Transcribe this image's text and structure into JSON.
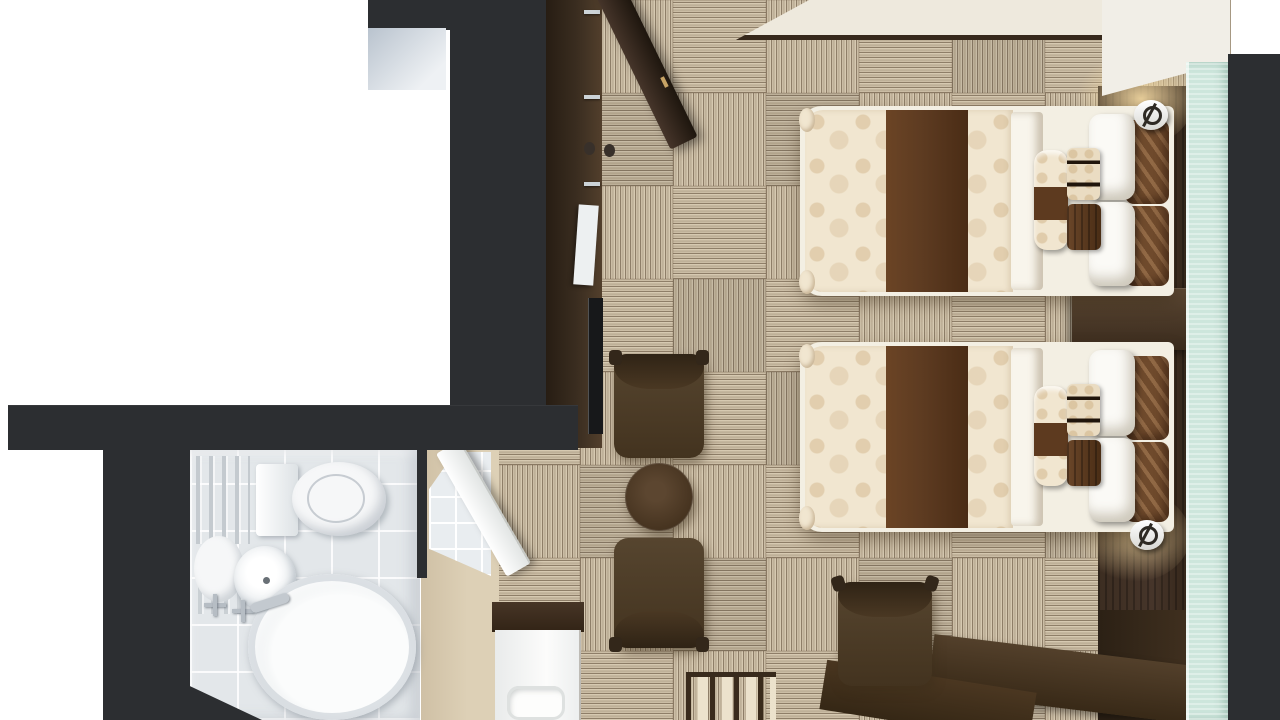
{
  "scene": {
    "type": "hotel-twin-room-floor-plan",
    "view": "top-down-3d-render",
    "rooms": [
      "bedroom",
      "bathroom",
      "entry-corridor"
    ]
  },
  "palette": {
    "wall_charcoal": "#2c2e31",
    "carpet_light": "#cbbda5",
    "carpet_dark": "#8e7e68",
    "entry_floor": "#ddd0b6",
    "wood_dark": "#3a2d20",
    "headboard_brown": "#46352a",
    "duvet_cream": "#f1e6d0",
    "runner_brown": "#5d3b21",
    "sheet_white": "#f8f5ec",
    "pillow_white": "#fbfaf6",
    "pillow_leaf": "#6f4a2c",
    "curtain_teal": "#cde6dc",
    "tile_gray": "#e3e7ea",
    "fixture_white": "#f6f7f8",
    "slab_cream": "#eee9dd",
    "panel_gray": "#b9c3ce",
    "tv_black": "#17181a",
    "glow_warm": "#f0d6a0"
  },
  "furniture": [
    {
      "name": "bed-1",
      "kind": "twin bed",
      "bedding": "cream floral duvet with brown runner"
    },
    {
      "name": "bed-2",
      "kind": "twin bed",
      "bedding": "cream floral duvet with brown runner"
    },
    {
      "name": "nightstand",
      "kind": "bedside table between beds"
    },
    {
      "name": "wall-sconce-1",
      "kind": "reading lamp above bed 1"
    },
    {
      "name": "wall-sconce-2",
      "kind": "reading lamp below bed 2"
    },
    {
      "name": "armchair-1",
      "kind": "lounge chair"
    },
    {
      "name": "armchair-2",
      "kind": "lounge chair"
    },
    {
      "name": "round-table",
      "kind": "coffee table"
    },
    {
      "name": "desk",
      "kind": "L-shaped work desk"
    },
    {
      "name": "desk-chair",
      "kind": "upholstered desk chair"
    },
    {
      "name": "luggage-rack",
      "kind": "slatted luggage bench"
    },
    {
      "name": "wardrobe",
      "kind": "open closet with door ajar"
    },
    {
      "name": "tv-console",
      "kind": "media cabinet"
    },
    {
      "name": "vanity",
      "kind": "washbasin unit"
    },
    {
      "name": "toilet",
      "kind": "toilet with tank"
    },
    {
      "name": "bathtub",
      "kind": "oval soaking tub"
    },
    {
      "name": "sink",
      "kind": "round bathroom basin"
    },
    {
      "name": "curtain",
      "kind": "teal window curtain strip"
    }
  ],
  "carpet": {
    "rows": 8,
    "cols": 8,
    "tile_px": 93,
    "pattern": "checkerboard striped tiles"
  }
}
